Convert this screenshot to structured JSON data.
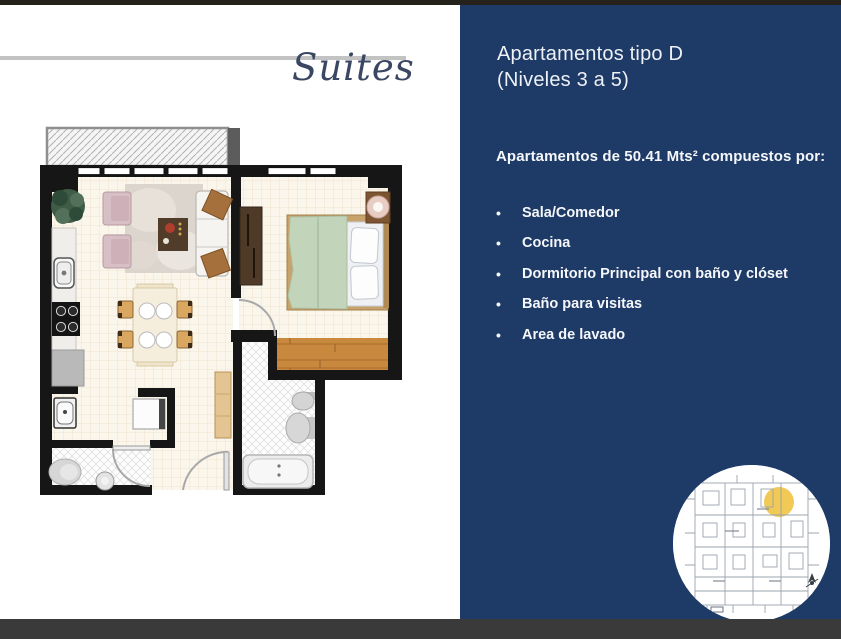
{
  "slide": {
    "logo": "Suites",
    "panel": {
      "title_line1": "Apartamentos tipo D",
      "title_line2": "(Niveles 3 a 5)",
      "subtitle": "Apartamentos de 50.41 Mts² compuestos por:",
      "bullet_char": "•",
      "bullets": [
        "Sala/Comedor",
        "Cocina",
        "Dormitorio Principal con baño y clóset",
        "Baño para visitas",
        "Area de lavado"
      ]
    },
    "colors": {
      "panel_navy": "#1e3a66",
      "bottom_bar_gray": "#3a3a3a",
      "top_strip_dark": "#24221b",
      "rule_gray": "#c3c3c3",
      "logo_navy": "#3a4763",
      "location_highlight_yellow": "#f0c64e",
      "floorplan_wall_black": "#161616",
      "floorplan_wood": "#c8883e",
      "floorplan_bed_green": "#c2d4ba"
    }
  }
}
